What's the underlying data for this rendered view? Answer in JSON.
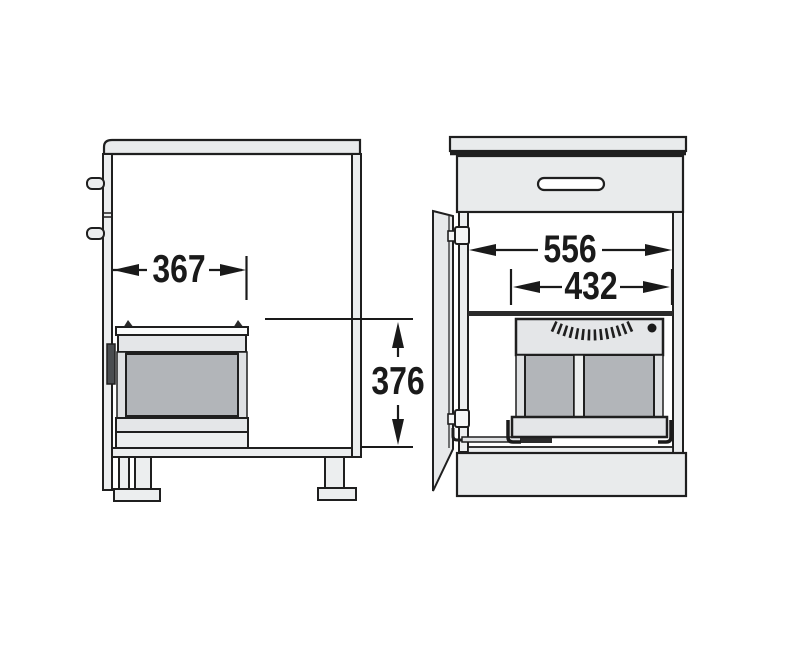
{
  "diagram": {
    "kind": "technical-dimension-drawing",
    "subject": "kitchen base cabinet with pull-out double waste bin",
    "side_view": {
      "depth_dim": "367",
      "height_dim": "376"
    },
    "front_view": {
      "inner_width_dim": "556",
      "unit_width_dim": "432"
    },
    "colors": {
      "line": "#1f1f1f",
      "panel_light": "#e9ebec",
      "panel_shade": "#e4e6e8",
      "rail_gray": "#dfe1e3",
      "bin_gray": "#b2b5b9",
      "background": "#ffffff"
    }
  }
}
